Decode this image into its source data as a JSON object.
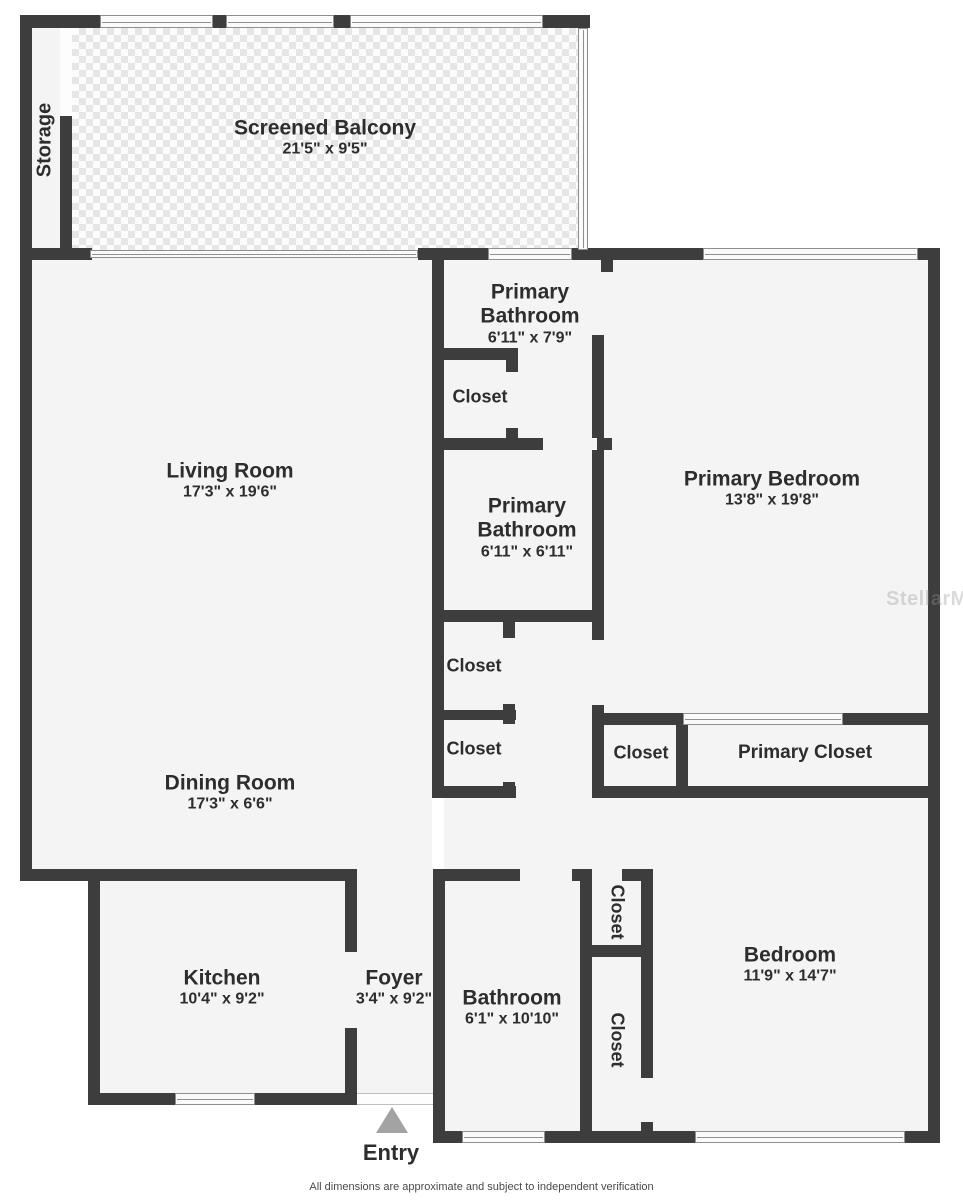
{
  "page": {
    "footer": "All dimensions are approximate and subject to independent verification",
    "watermark": "StellarMLS",
    "entry_label": "Entry"
  },
  "rooms": {
    "storage": {
      "name": "Storage"
    },
    "balcony": {
      "name": "Screened Balcony",
      "dims": "21'5\" x 9'5\""
    },
    "living": {
      "name": "Living Room",
      "dims": "17'3\" x 19'6\""
    },
    "dining": {
      "name": "Dining Room",
      "dims": "17'3\" x 6'6\""
    },
    "primary_bath_1": {
      "name": "Primary Bathroom",
      "dims": "6'11\" x 7'9\""
    },
    "primary_bath_2": {
      "name": "Primary Bathroom",
      "dims": "6'11\" x 6'11\""
    },
    "primary_bedroom": {
      "name": "Primary Bedroom",
      "dims": "13'8\" x 19'8\""
    },
    "primary_closet": {
      "name": "Primary Closet"
    },
    "closet_a": {
      "name": "Closet"
    },
    "closet_b": {
      "name": "Closet"
    },
    "closet_c": {
      "name": "Closet"
    },
    "closet_d": {
      "name": "Closet"
    },
    "closet_e": {
      "name": "Closet"
    },
    "closet_f": {
      "name": "Closet"
    },
    "kitchen": {
      "name": "Kitchen",
      "dims": "10'4\" x 9'2\""
    },
    "foyer": {
      "name": "Foyer",
      "dims": "3'4\" x 9'2\""
    },
    "bathroom": {
      "name": "Bathroom",
      "dims": "6'1\" x 10'10\""
    },
    "bedroom": {
      "name": "Bedroom",
      "dims": "11'9\" x 14'7\""
    }
  }
}
